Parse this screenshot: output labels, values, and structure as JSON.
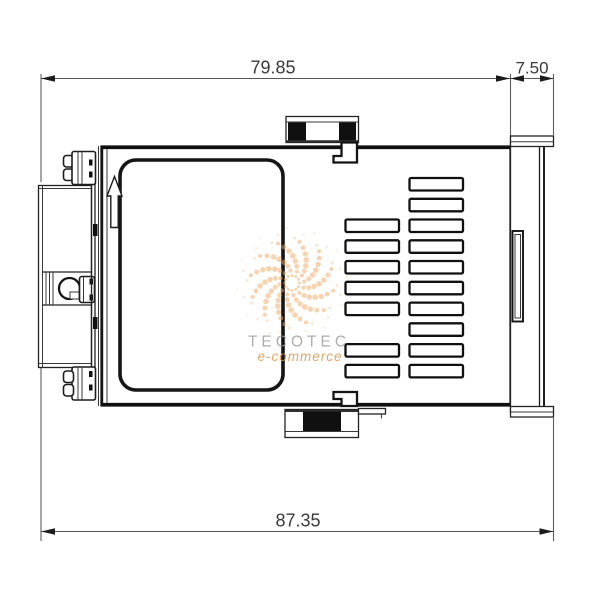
{
  "drawing": {
    "dimensions": [
      {
        "id": "top_width",
        "value": "79.85"
      },
      {
        "id": "bezel_depth",
        "value": "7.50"
      },
      {
        "id": "total_depth",
        "value": "87.35"
      }
    ],
    "colors": {
      "part_line": "#1a1a1a",
      "dim_line": "#575757",
      "dim_text": "#3a3a3a",
      "black_fill": "#101010"
    },
    "vents": {
      "slot_width": 53.5,
      "slot_height": 12.5,
      "corner_radius": 1.5,
      "columns": [
        {
          "x": 345.5,
          "rows": [
            219.5,
            240.3,
            261.0,
            281.8,
            302.6,
            344.1,
            364.9
          ]
        },
        {
          "x": 409.5,
          "rows": [
            178.0,
            198.8,
            219.5,
            240.3,
            261.0,
            281.8,
            302.6,
            323.3,
            344.1,
            364.9
          ]
        }
      ]
    }
  },
  "watermark": {
    "title": "TECOTEC",
    "subtitle": "e-commerce",
    "title_color": "#9a9a9a",
    "subtitle_color": "#e0964e",
    "logo_color": "#f0a85f",
    "logo_spiral": {
      "cx": 292,
      "cy": 283,
      "arms": 12,
      "dots_per_arm": 8,
      "base_radius": 7.5,
      "radius_step": 4.9,
      "twist": 0.4,
      "halo_radius": 45,
      "opacity": 0.5
    }
  }
}
